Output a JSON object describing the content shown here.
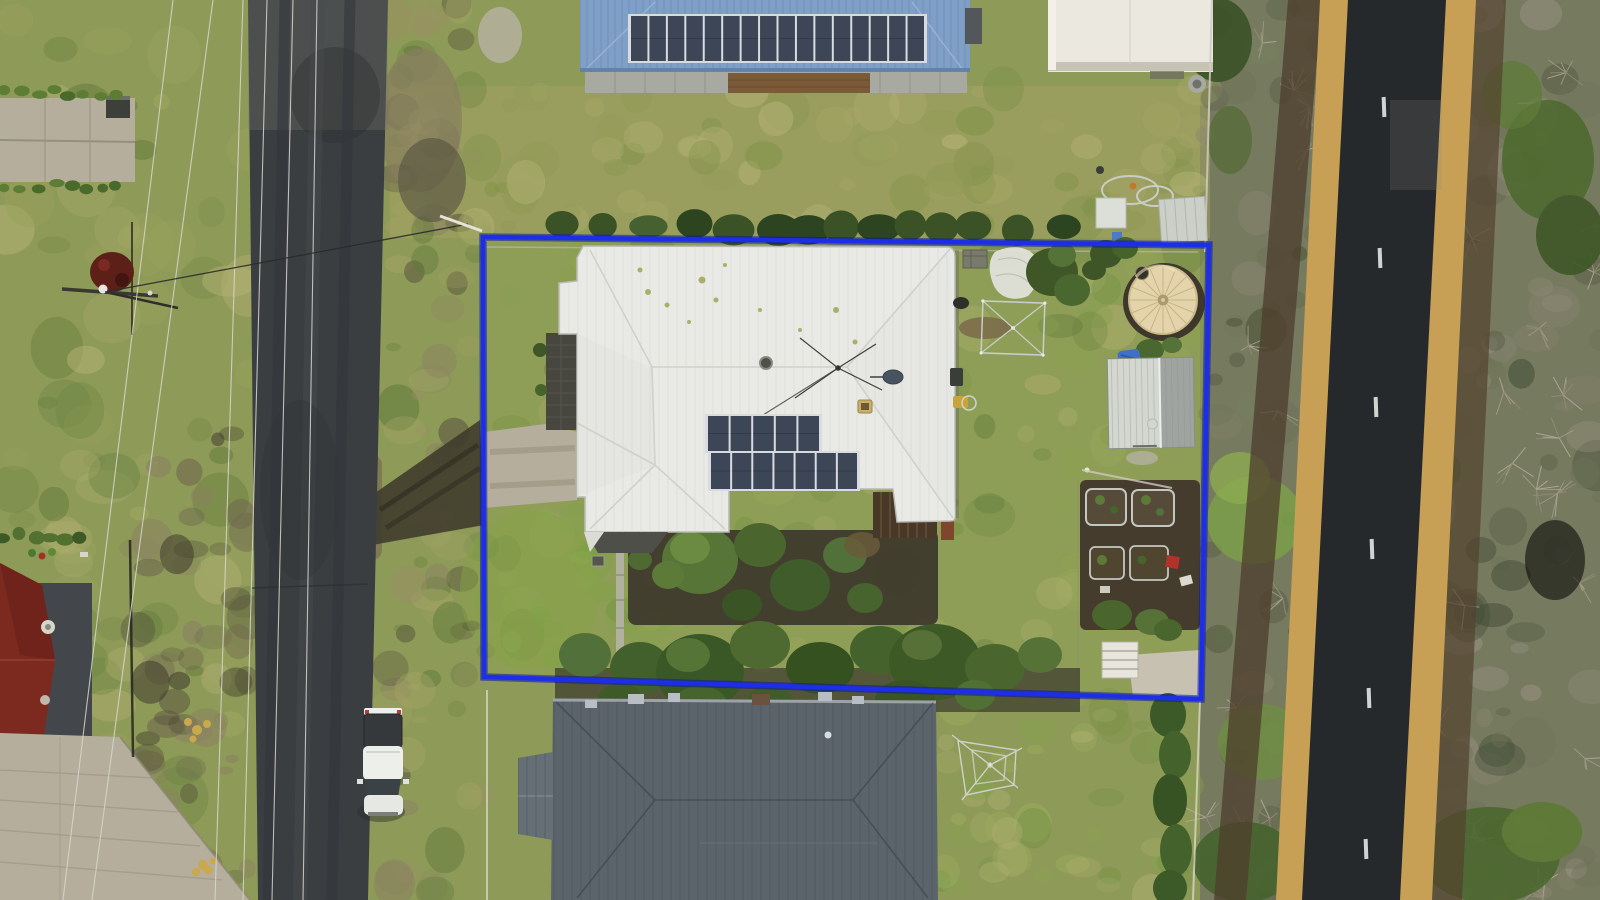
{
  "image_type": "aerial-drone-photograph",
  "scene": {
    "description": "Top-down aerial photo of a residential lot outlined with a blue property-boundary overlay; sealed street on the left with a parked white ute, tree-lined country road on the right, neighbouring houses above and below.",
    "overlay": {
      "type": "property-boundary",
      "corners": [
        [
          483,
          237
        ],
        [
          1209,
          245
        ],
        [
          1201,
          699
        ],
        [
          484,
          677
        ]
      ]
    },
    "objects": [
      "property-boundary-overlay",
      "main-house-white-roof",
      "rooftop-solar-array",
      "tv-antenna",
      "satellite-dish",
      "roof-vent-ring",
      "rear-pergola",
      "courtyard-garden",
      "concrete-driveway",
      "dark-paver-path",
      "front-lawn",
      "back-lawn",
      "rainwater-tank",
      "garden-shed",
      "blue-tarp",
      "raised-garden-beds",
      "red-wheelbarrow",
      "concrete-slab",
      "boundary-tree-row",
      "netted-garden-frame",
      "white-tarp",
      "garden-crate",
      "top-boundary-hedge",
      "neighbour-house-blue-roof",
      "neighbour-solar-strip",
      "neighbour-garage",
      "equipment-yard",
      "hose-coils",
      "neighbour-house-grey-roof",
      "rotary-clothesline",
      "left-street",
      "white-ute",
      "power-pole",
      "power-lines",
      "service-wire",
      "red-roof-house",
      "paved-patio",
      "garden-hedge-rows",
      "right-road",
      "road-centre-dashes",
      "gravel-shoulders",
      "roadside-scrub",
      "bare-trees"
    ]
  },
  "solar": {
    "neighbour_panels": 16,
    "house_top_row": 5,
    "house_bottom_row": 7
  },
  "right_road": {
    "dash_count": 6,
    "dashes": [
      [
        1384,
        97
      ],
      [
        1380,
        248
      ],
      [
        1376,
        397
      ],
      [
        1372,
        539
      ],
      [
        1369,
        688
      ],
      [
        1366,
        839
      ]
    ]
  },
  "palette": {
    "boundary_blue": "#1c2ee8",
    "boundary_edge": "#0d1a9e",
    "grass_base": "#8e9a58",
    "grass_prop": "#90a156",
    "grass_top": "#a3a162",
    "grass_bright": "#7fa04a",
    "asphalt": "#3a3e41",
    "asphalt_dark": "#26292b",
    "sand": "#c7a055",
    "concrete": "#b5ae9c",
    "paver_dark": "#474740",
    "roof_white": "#e9e9e6",
    "roof_grey": "#5b636b",
    "roof_blue": "#7f9fc6",
    "roof_red": "#7c2a20",
    "solar_cell": "#3c4656",
    "solar_frame": "#d8dce0",
    "tank_cream": "#e4d4ab",
    "shed_white": "#d4d6d0",
    "hedge_green": "#3f5727",
    "tree_green": "#42602b",
    "scrub": "#767a5f",
    "bare_branch": "#a89f8c",
    "soil_dark": "#3f3a2c",
    "wire": "#d8d6cf",
    "vehicle_white": "#edefeb"
  }
}
